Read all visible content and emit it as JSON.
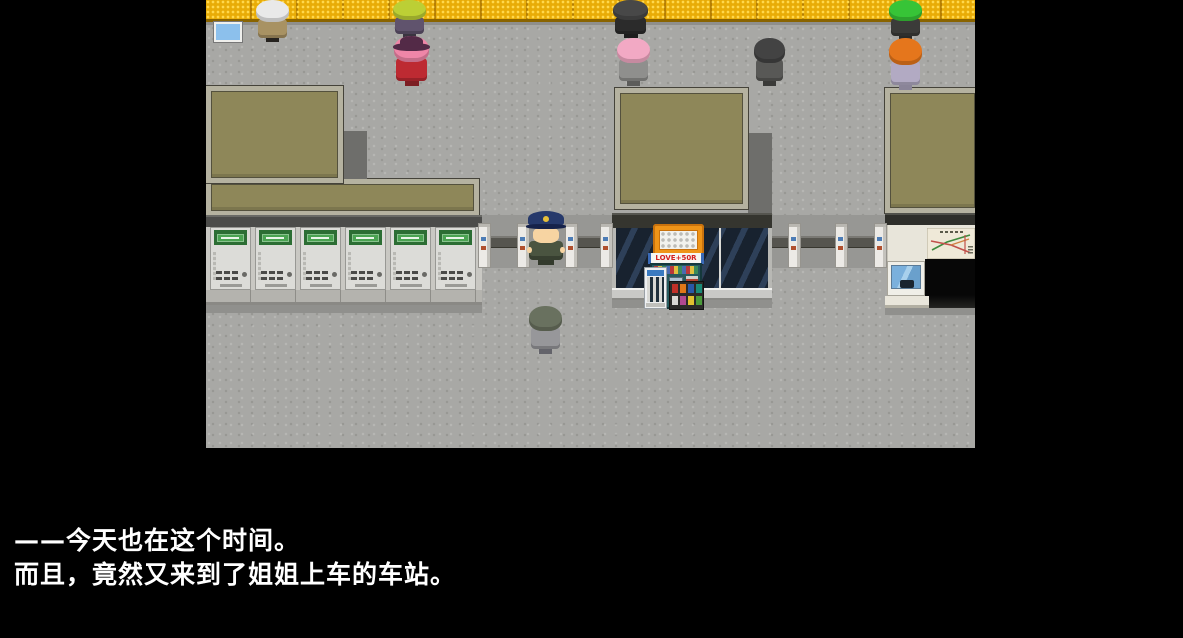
{
  "window": {
    "width": 1183,
    "height": 638,
    "background": "#000000"
  },
  "viewport": {
    "x": 206,
    "y": 0,
    "width": 769,
    "height": 448,
    "description": "rpg-station-scene"
  },
  "dialogue": {
    "line1": "——今天也在这个时间。",
    "line2": "而且，竟然又来到了姐姐上车的车站。",
    "text_color": "#ffffff"
  },
  "scene": {
    "floor_color": "#a8a8a5",
    "yellow_wall": {
      "color": "#e8ac07",
      "dot_color": "#ffd84d",
      "seam_color": "rgba(140,90,0,0.55)",
      "edge_color": "#8a6400",
      "height": 22
    },
    "palette": {
      "roof_fill": "#8e8759",
      "roof_border": "#b5b2a0",
      "roof_edge": "#54513d",
      "shadow_block": "#6e6e6b",
      "dark_band": "#4c4c4a",
      "machine_wall": "#c9c8c3",
      "machine_base": "#b4b3ae",
      "glass_dark": "#18222f",
      "glass_light": "#2e4059",
      "silver_band": "#c9c9c6",
      "corridor_shadow": "#979794",
      "floor_shadow": "#90908d",
      "gate_white": "#eceae6",
      "gate_bar": "#56554f",
      "machine_green": "#2c6e34",
      "machine_sign": "#4aa352",
      "machine_screen": "#8cc0ec",
      "kiosk_orange": "#ef9418",
      "wall_white": "#e8e5da",
      "entrance_black": "#070707"
    },
    "kiosk": {
      "banner_text": "LOVE+50R",
      "banner_text_color": "#d42020"
    },
    "ticket_machines": {
      "count": 6,
      "xs": [
        4,
        49,
        94,
        139,
        184,
        229
      ],
      "y": 227,
      "w": 41,
      "h": 63
    },
    "gates": {
      "pillars": [
        272,
        311,
        359,
        394,
        582,
        629,
        668
      ],
      "pillar_y": 223,
      "pillar_w": 13,
      "pillar_h": 45,
      "bars": [
        {
          "x": 285,
          "w": 26
        },
        {
          "x": 372,
          "w": 22
        },
        {
          "x": 566,
          "w": 16
        },
        {
          "x": 595,
          "w": 34
        },
        {
          "x": 642,
          "w": 26
        }
      ],
      "bar_y": 236,
      "bar_h": 12
    },
    "characters": [
      {
        "name": "npc-white-spiky",
        "x": 50,
        "y": 0,
        "w": 33,
        "h": 42,
        "type": "back",
        "hair": "#e9e9e9",
        "body": "#a89263",
        "legs": "#26231f"
      },
      {
        "name": "npc-chartreuse",
        "x": 187,
        "y": 0,
        "w": 33,
        "h": 38,
        "type": "back",
        "hair": "#bccf35",
        "body": "#60536d",
        "legs": "#3a3440"
      },
      {
        "name": "npc-hat-lady",
        "x": 188,
        "y": 36,
        "w": 35,
        "h": 50,
        "type": "hat",
        "hat": "#532a47",
        "hair": "#ef86a8",
        "body": "#bd2a32",
        "legs": "#7c1d22"
      },
      {
        "name": "npc-black-coat",
        "x": 407,
        "y": 0,
        "w": 35,
        "h": 38,
        "type": "back",
        "hair": "#484848",
        "body": "#2b2b2b",
        "legs": "#1d1d1d"
      },
      {
        "name": "npc-pink-hair",
        "x": 411,
        "y": 38,
        "w": 33,
        "h": 48,
        "type": "back",
        "hair": "#f2a9c4",
        "body": "#8f8f8d",
        "legs": "#5c5c5a"
      },
      {
        "name": "npc-gray-bob",
        "x": 548,
        "y": 38,
        "w": 31,
        "h": 48,
        "type": "back",
        "hair": "#434343",
        "body": "#585856",
        "legs": "#3a3a38"
      },
      {
        "name": "npc-green-hair",
        "x": 683,
        "y": 0,
        "w": 33,
        "h": 40,
        "type": "back",
        "hair": "#37c437",
        "body": "#3b3b39",
        "legs": "#2a2a28"
      },
      {
        "name": "npc-orange-hair",
        "x": 683,
        "y": 38,
        "w": 33,
        "h": 52,
        "type": "back",
        "hair": "#e5761c",
        "body": "#b2aac3",
        "legs": "#8a8498"
      },
      {
        "name": "station-attendant",
        "x": 321,
        "y": 211,
        "w": 38,
        "h": 54,
        "type": "capped",
        "cap": "#26396b",
        "brim": "#16224a",
        "badge": "#e7bf3a",
        "face": "#f7d4a2",
        "body": "#4a5440",
        "legs": "#333a2c"
      },
      {
        "name": "player-character",
        "x": 323,
        "y": 306,
        "w": 33,
        "h": 48,
        "type": "back",
        "hair": "#69715f",
        "body": "#97979a",
        "legs": "#63636a"
      }
    ]
  }
}
